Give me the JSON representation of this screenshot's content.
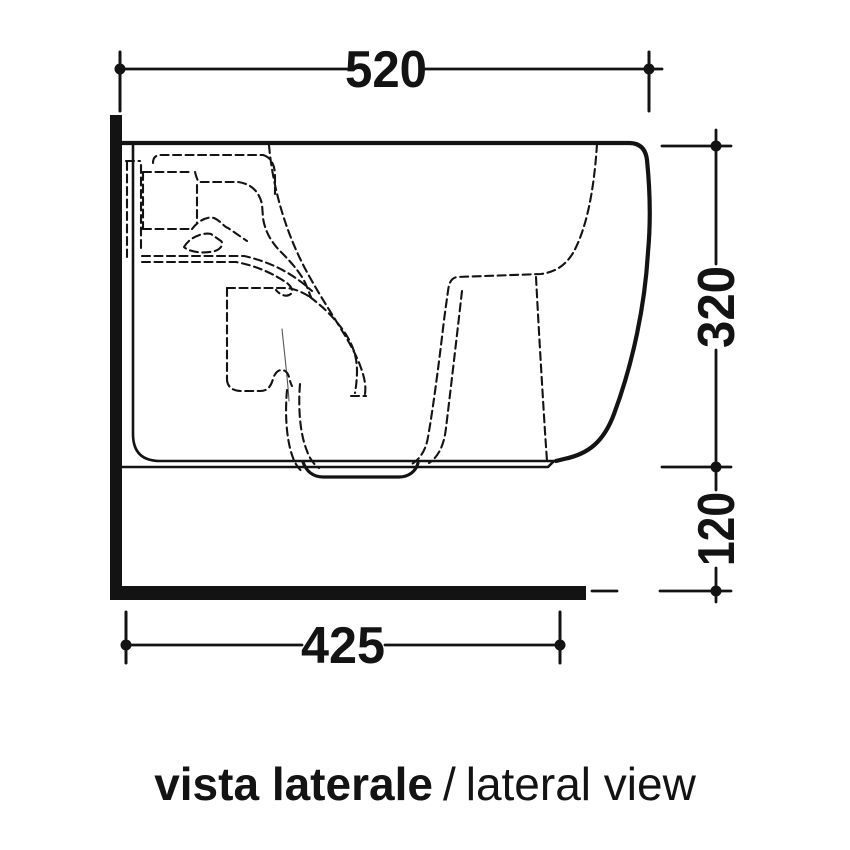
{
  "drawing": {
    "caption": {
      "title_it": "vista laterale",
      "divider": "/",
      "title_en": "lateral view"
    },
    "dimensions": {
      "depth_top": {
        "label": "520"
      },
      "height_body": {
        "label": "320"
      },
      "height_floor_gap": {
        "label": "120"
      },
      "depth_bottom": {
        "label": "425"
      }
    },
    "colors": {
      "line": "#131313",
      "background": "#ffffff"
    }
  }
}
